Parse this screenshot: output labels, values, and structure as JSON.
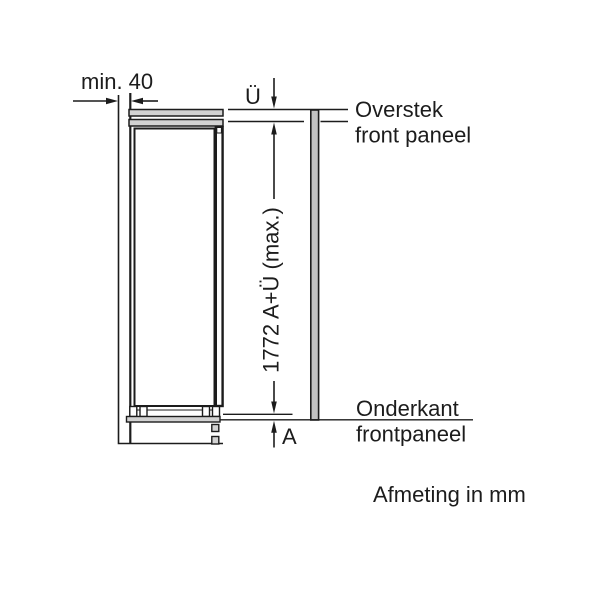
{
  "diagram": {
    "type": "appliance-installation-drawing",
    "units_note": "Afmeting in mm",
    "dimensions": {
      "min_clearance": "min. 40",
      "overhang_symbol": "Ü",
      "height_formula": "1772 A+Ü (max.)",
      "bottom_gap_symbol": "A"
    },
    "labels": {
      "overhang_line1": "Overstek",
      "overhang_line2": "front paneel",
      "bottom_line1": "Onderkant",
      "bottom_line2": "frontpaneel"
    }
  },
  "colors": {
    "line": "#1c1c1c",
    "light_fill": "#d2d2d2",
    "panel_fill": "#c2c2c2",
    "interior_fill": "#ffffff",
    "background": "#ffffff"
  }
}
